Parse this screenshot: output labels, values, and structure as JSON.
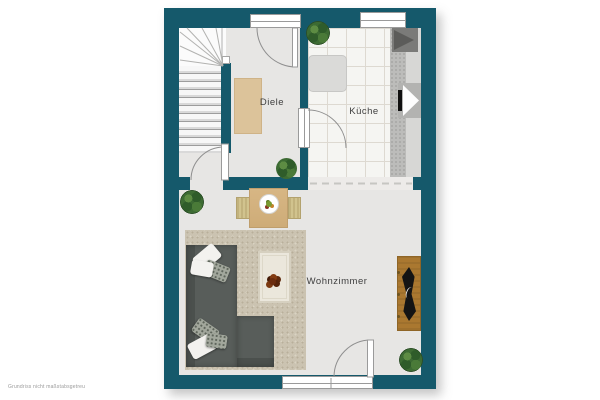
{
  "page": {
    "type": "floor-plan",
    "footer_note": "Grundriss nicht maßstabsgetreu",
    "background": "#ffffff"
  },
  "plan": {
    "rooms": [
      {
        "id": "diele",
        "label": "Diele"
      },
      {
        "id": "kueche",
        "label": "Küche"
      },
      {
        "id": "wohnzimmer",
        "label": "Wohnzimmer"
      }
    ],
    "features": {
      "stairs": "winder-staircase",
      "doors": [
        "entrance-door",
        "diele-kueche-door",
        "diele-wohnzimmer-door",
        "terrace-door"
      ],
      "windows": [
        "kueche-window",
        "wohnzimmer-window"
      ],
      "furniture": [
        "kitchen-counter",
        "kitchen-appliance",
        "kitchen-sink",
        "kitchen-table",
        "doormat",
        "dining-table",
        "dining-chairs",
        "fruit-bowl",
        "corner-sofa",
        "pillows",
        "area-rug",
        "coffee-table",
        "ornament",
        "sideboard",
        "tv"
      ],
      "plants": 4
    },
    "colors": {
      "wall": "#15596b",
      "floor": "#e7e6e4",
      "tile": "#f5f5f2",
      "carpet": "#cbc3b1",
      "sofa": "#585d5a",
      "wood": "#d7b684",
      "sideboard": "#aa7830",
      "plant": "#3d6b33",
      "doormat": "#dcc39a"
    }
  }
}
